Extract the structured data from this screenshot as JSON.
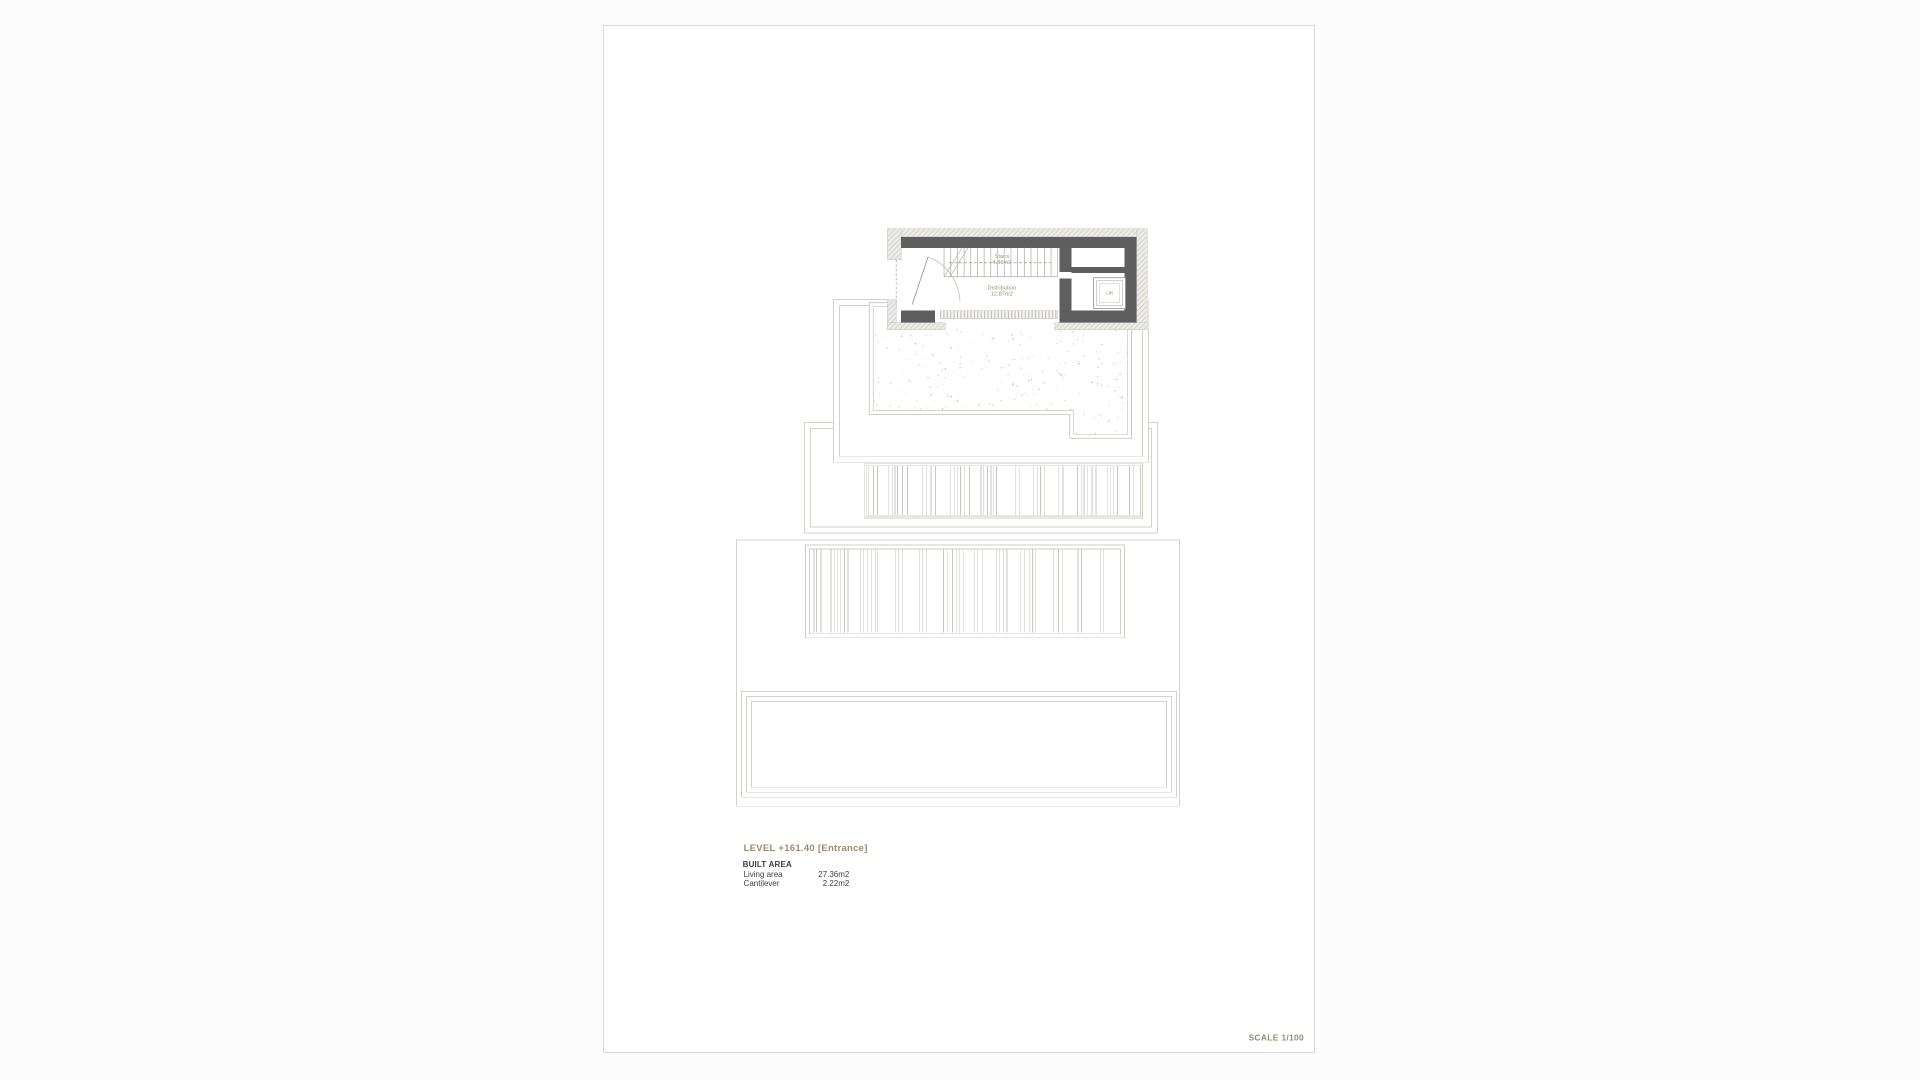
{
  "drawing": {
    "level_title": "LEVEL +161.40 [Entrance]",
    "scale_label": "SCALE 1/100",
    "built_area": {
      "heading": "BUILT AREA",
      "rows": [
        {
          "label": "Living area",
          "value": "27.36m2"
        },
        {
          "label": "Cantilever",
          "value": "2.22m2"
        }
      ]
    },
    "rooms": {
      "stairs": {
        "name": "Stairs",
        "area": "4.80m2"
      },
      "distribution": {
        "name": "Distribution",
        "area": "12.87m2"
      },
      "lift": {
        "name": "Lift"
      }
    },
    "colors": {
      "accent_tan": "#9c8970",
      "wall_dark": "#5e5e5e",
      "outline_light": "#d4d1cc",
      "detail_gray": "#aeaba6",
      "text_dark": "#3f3f3f"
    }
  }
}
